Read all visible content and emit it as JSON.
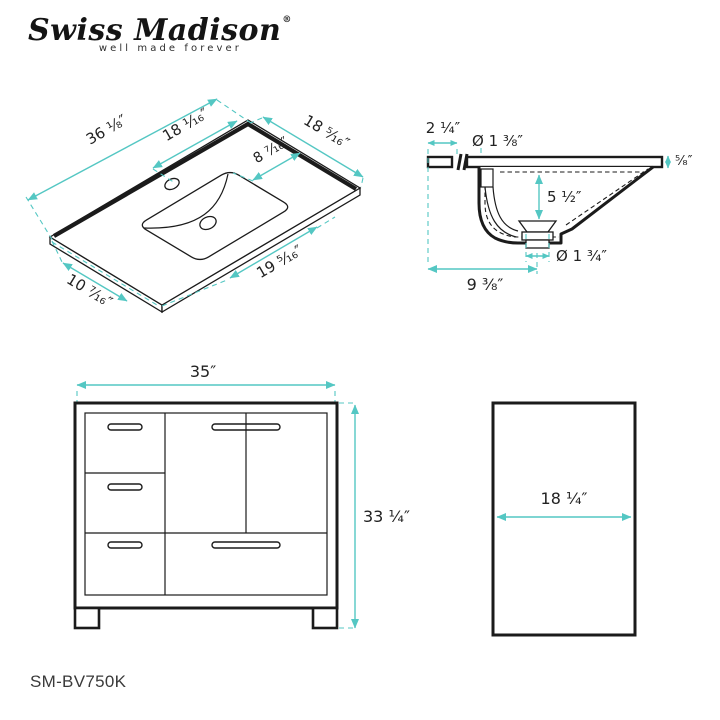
{
  "brand": {
    "logo_text": "Swiss Madison",
    "registered_mark": "®",
    "tagline": "well made forever"
  },
  "model_number": "SM-BV750K",
  "colors": {
    "dimension_accent": "#54c7c3",
    "drawing_line": "#1b1b1b"
  },
  "views": {
    "sink_top": {
      "label": "Countertop top perspective view",
      "dims": {
        "overall_width": "36 ¹⁄₈″",
        "left_to_basin_center": "18 ¹⁄₁₆″",
        "basin_to_back_edge": "8 ⁷⁄₁₆″",
        "overall_depth": "18 ⁵⁄₁₆″",
        "basin_to_right_edge": "19 ⁵⁄₁₆″",
        "left_edge_to_basin": "10 ⁷⁄₁₆″"
      }
    },
    "sink_section": {
      "label": "Sink cross-section view",
      "dims": {
        "back_overhang": "2 ¹⁄₄″",
        "faucet_hole_diameter": "Ø 1 ³⁄₈″",
        "countertop_thickness": "⁵⁄₈″",
        "basin_depth": "5 ¹⁄₂″",
        "drain_diameter": "Ø 1 ³⁄₄″",
        "edge_to_drain_center": "9 ³⁄₈″"
      }
    },
    "vanity_front": {
      "label": "Vanity cabinet front view",
      "dims": {
        "width": "35″",
        "height": "33 ¹⁄₄″"
      }
    },
    "vanity_side": {
      "label": "Vanity cabinet side view",
      "dims": {
        "depth": "18 ¹⁄₄″"
      }
    }
  }
}
